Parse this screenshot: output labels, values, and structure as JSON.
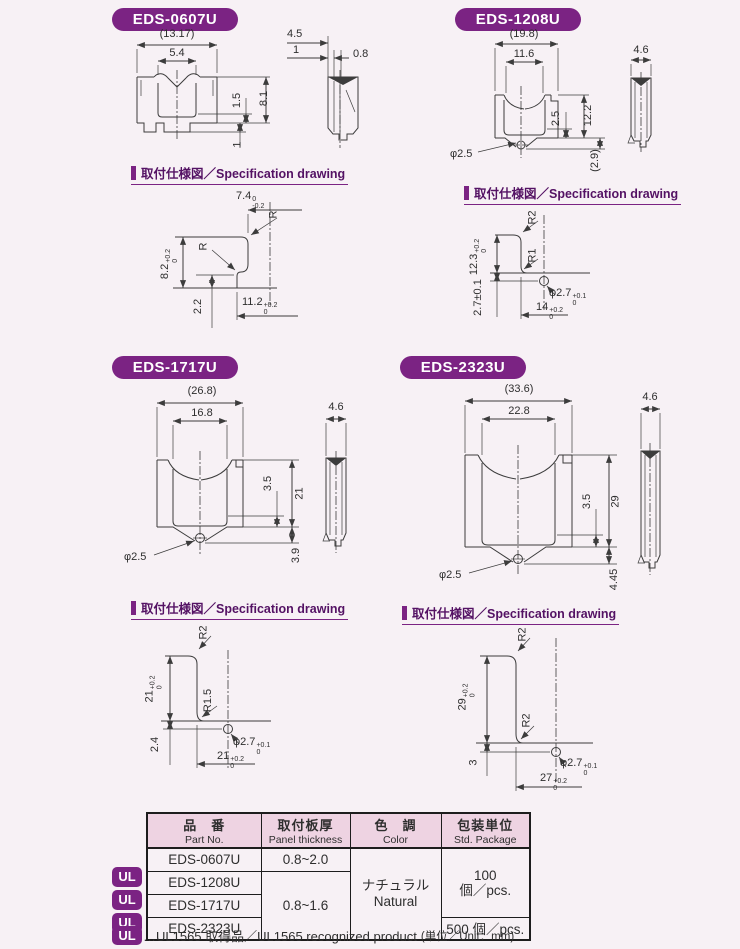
{
  "colors": {
    "accent_purple": "#7b2383",
    "heading_purple": "#541264",
    "table_header_pink": "#eed3e2",
    "line_gray": "#3c3c3c",
    "page_bg": "#f7f1f5"
  },
  "spec_heading": "取付仕様図／Specification drawing",
  "sections": {
    "s1": {
      "title": "EDS-0607U",
      "front": {
        "overall": "(13.17)",
        "inner": "5.4",
        "step": "1.5",
        "height": "8.1",
        "foot": "1"
      },
      "side": {
        "depth": "4.5",
        "d1": "1",
        "d2": "0.8"
      },
      "spec": {
        "top_w": "7.4",
        "top_w_up": "0",
        "top_w_dn": "-0.2",
        "r_top": "R",
        "r_mid": "R",
        "h": "8.2",
        "h_up": "+0.2",
        "h_dn": "0",
        "step": "2.2",
        "w": "11.2",
        "w_up": "+0.2",
        "w_dn": "0"
      }
    },
    "s2": {
      "title": "EDS-1208U",
      "front": {
        "overall": "(19.8)",
        "inner": "11.6",
        "step": "2.5",
        "height": "12.2",
        "below": "(2.9)",
        "hole": "φ2.5"
      },
      "side": {
        "depth": "4.6"
      },
      "spec": {
        "r_top": "R2",
        "r_bot": "R1",
        "h": "12.3",
        "h_up": "+0.2",
        "h_dn": "0",
        "edge": "2.7±0.1",
        "hole": "φ2.7",
        "hole_up": "+0.1",
        "hole_dn": "0",
        "w": "14",
        "w_up": "+0.2",
        "w_dn": "0"
      }
    },
    "s3": {
      "title": "EDS-1717U",
      "front": {
        "overall": "(26.8)",
        "inner": "16.8",
        "step": "3.5",
        "height": "21",
        "below": "3.9",
        "hole": "φ2.5"
      },
      "side": {
        "depth": "4.6"
      },
      "spec": {
        "r_top": "R2",
        "r_bot": "R1.5",
        "h": "21",
        "h_up": "+0.2",
        "h_dn": "0",
        "edge": "2.4",
        "hole": "φ2.7",
        "hole_up": "+0.1",
        "hole_dn": "0",
        "w": "21",
        "w_up": "+0.2",
        "w_dn": "0"
      }
    },
    "s4": {
      "title": "EDS-2323U",
      "front": {
        "overall": "(33.6)",
        "inner": "22.8",
        "step": "3.5",
        "height": "29",
        "below": "4.45",
        "hole": "φ2.5"
      },
      "side": {
        "depth": "4.6"
      },
      "spec": {
        "r_top": "R2",
        "r_bot": "R2",
        "h": "29",
        "h_up": "+0.2",
        "h_dn": "0",
        "edge": "3",
        "hole": "φ2.7",
        "hole_up": "+0.1",
        "hole_dn": "0",
        "w": "27",
        "w_up": "+0.2",
        "w_dn": "0"
      }
    }
  },
  "table": {
    "headers": {
      "part_jp": "品　番",
      "part_en": "Part No.",
      "thickness_jp": "取付板厚",
      "thickness_en": "Panel thickness",
      "color_jp": "色　調",
      "color_en": "Color",
      "package_jp": "包装単位",
      "package_en": "Std. Package"
    },
    "rows": [
      {
        "part": "EDS-0607U",
        "ul": ""
      },
      {
        "part": "EDS-1208U",
        "ul": "UL"
      },
      {
        "part": "EDS-1717U",
        "ul": "UL"
      },
      {
        "part": "EDS-2323U",
        "ul": "UL"
      }
    ],
    "thickness_row1": "0.8~2.0",
    "thickness_rows234": "0.8~1.6",
    "color_jp": "ナチュラル",
    "color_en": "Natural",
    "package_rows123_qty": "100",
    "package_rows123_unit": "個／pcs.",
    "package_row4": "500 個／pcs.",
    "ul_badge": "UL",
    "footnote": "…UL1565 取得品／UL1565 recognized product",
    "unit_note": "(単位／Unit：mm)"
  }
}
